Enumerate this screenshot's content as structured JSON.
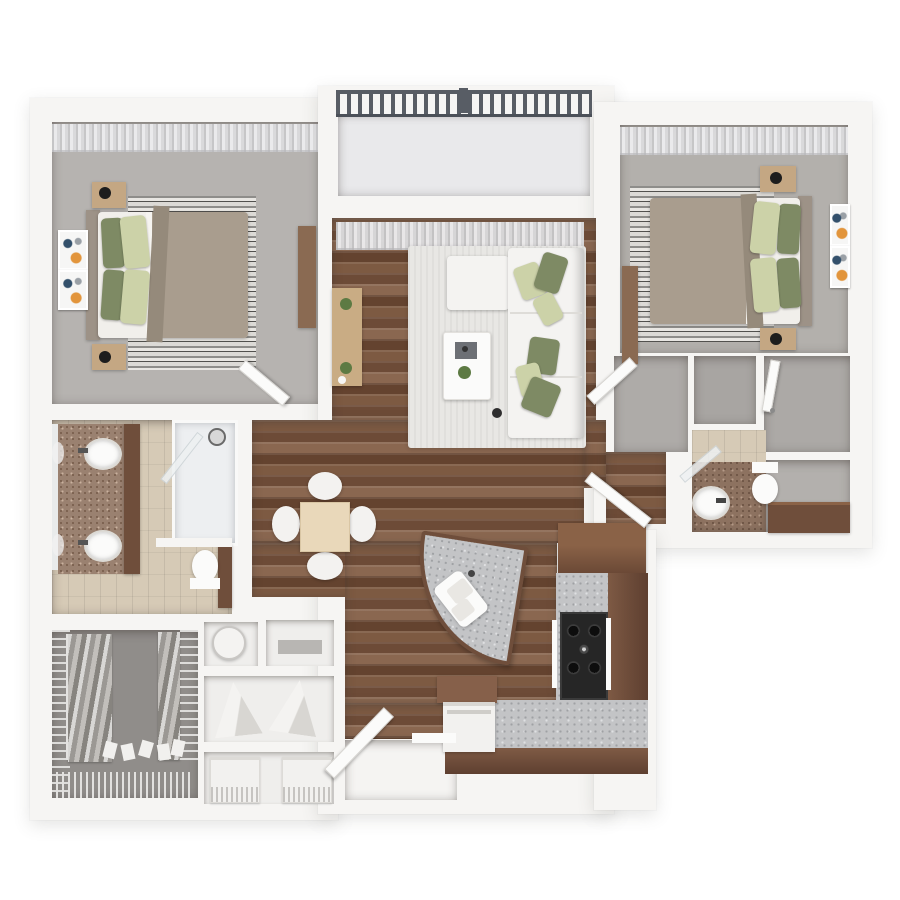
{
  "image": {
    "kind": "3d-floor-plan-rendering",
    "view": "top-down dollhouse",
    "visible_text": [],
    "unit_summary": {
      "bedrooms": 2,
      "bathrooms": 2,
      "balcony": true,
      "walk_in_closets": true
    }
  },
  "palette": {
    "background": "#ffffff",
    "wall": "#f6f5f3",
    "balcony_floor": "#e9e9eb",
    "railing_dark": "#585d65",
    "carpet_bed1": "#b6b3b0",
    "carpet_bed2": "#b3b0ac",
    "carpet_hall": "#aeaba8",
    "closet_floor": "#908d8a",
    "closet_b": "#a8a5a2",
    "closet_c": "#aca9a6",
    "bath1_tile": "#d6cab6",
    "bath2_floor": "#8d7260",
    "bath2_base": "#b3b0ad",
    "vanity_top": "#9a8170",
    "mirror": "#e9ebeb",
    "rug_living": "#e8e7e4",
    "sofa": "#f4f3f1",
    "mattress": "#f1efeb",
    "sheet": "#f6f4f0",
    "blanket": "#a99d8e",
    "throw": "#958a7b",
    "headboard": "#9d9287",
    "pillow_dark": "#7e8a64",
    "pillow_light": "#ccd2a8",
    "nightstand": "#c4a783",
    "lamp": "#1d1d1d",
    "console_dark": "#8a6a52",
    "console_light": "#c9ac84",
    "table_wood": "#e9d8ba",
    "chair": "#f3f2f0",
    "coffee_table": "#fbfbfa",
    "tray": "#6d7075",
    "plant": "#5d7a43",
    "pot": "#2e2e2e",
    "walnut": "#6f4e3b",
    "walnut_light": "#86604a",
    "granite": "#c3c4c6",
    "cooktop": "#262626",
    "fixture": "#fbfbfa",
    "appliance": "#f2f1ef",
    "heater": "#f4f3f1",
    "slab": "#b8b6b3",
    "niche": "#efeeec",
    "landing": "#f5f4f2",
    "door": "#fbfbfa",
    "glass": "#eef1f2",
    "shoe": "#f1f0ee",
    "shower_pan": "#edeff1"
  },
  "rooms": [
    {
      "id": "balcony",
      "features": [
        "metal-railing",
        "concrete-floor"
      ]
    },
    {
      "id": "bedroom-1",
      "features": [
        "queen-bed",
        "two-nightstands",
        "two-table-lamps",
        "striped-area-rug",
        "two-wall-art-frames",
        "media-console",
        "sheer-curtains",
        "carpet"
      ]
    },
    {
      "id": "living-room",
      "features": [
        "white-sectional-sofa",
        "chaise-ottoman",
        "six-sage-throw-pillows",
        "coffee-table",
        "decor-tray",
        "potted-plants",
        "tv-console",
        "area-rug",
        "sheer-curtains",
        "hardwood-floor"
      ]
    },
    {
      "id": "bedroom-2",
      "features": [
        "queen-bed",
        "two-nightstands",
        "two-table-lamps",
        "striped-area-rug",
        "two-wall-art-frames",
        "dresser",
        "sheer-curtains",
        "carpet"
      ]
    },
    {
      "id": "bathroom-1",
      "features": [
        "double-sink-vanity",
        "mirror",
        "linen-cabinet",
        "glass-shower",
        "toilet",
        "tile-floor"
      ]
    },
    {
      "id": "dining-area",
      "features": [
        "square-table",
        "four-chairs",
        "hardwood-floor"
      ]
    },
    {
      "id": "kitchen",
      "features": [
        "curved-granite-island",
        "double-basin-sink",
        "l-shaped-counter",
        "gas-cooktop",
        "refrigerator",
        "dishwasher",
        "walnut-cabinets"
      ]
    },
    {
      "id": "bathroom-2",
      "features": [
        "round-vessel-sink",
        "toilet",
        "walnut-vanity",
        "tiled-shower",
        "glass-door"
      ]
    },
    {
      "id": "hallway",
      "features": [
        "carpet",
        "doors"
      ]
    },
    {
      "id": "closet-linen",
      "features": [
        "empty-floor"
      ]
    },
    {
      "id": "closet-bedroom-2",
      "features": [
        "open-door"
      ]
    },
    {
      "id": "walk-in-closet",
      "features": [
        "wire-shelving",
        "hanging-clothes",
        "shoe-rows",
        "shoe-rack"
      ]
    },
    {
      "id": "utility-storage",
      "features": [
        "water-heater",
        "shelf",
        "two-folded-racks",
        "washer-dryer-fronts"
      ]
    },
    {
      "id": "entry",
      "features": [
        "open-entry-door",
        "landing",
        "threshold"
      ]
    }
  ]
}
